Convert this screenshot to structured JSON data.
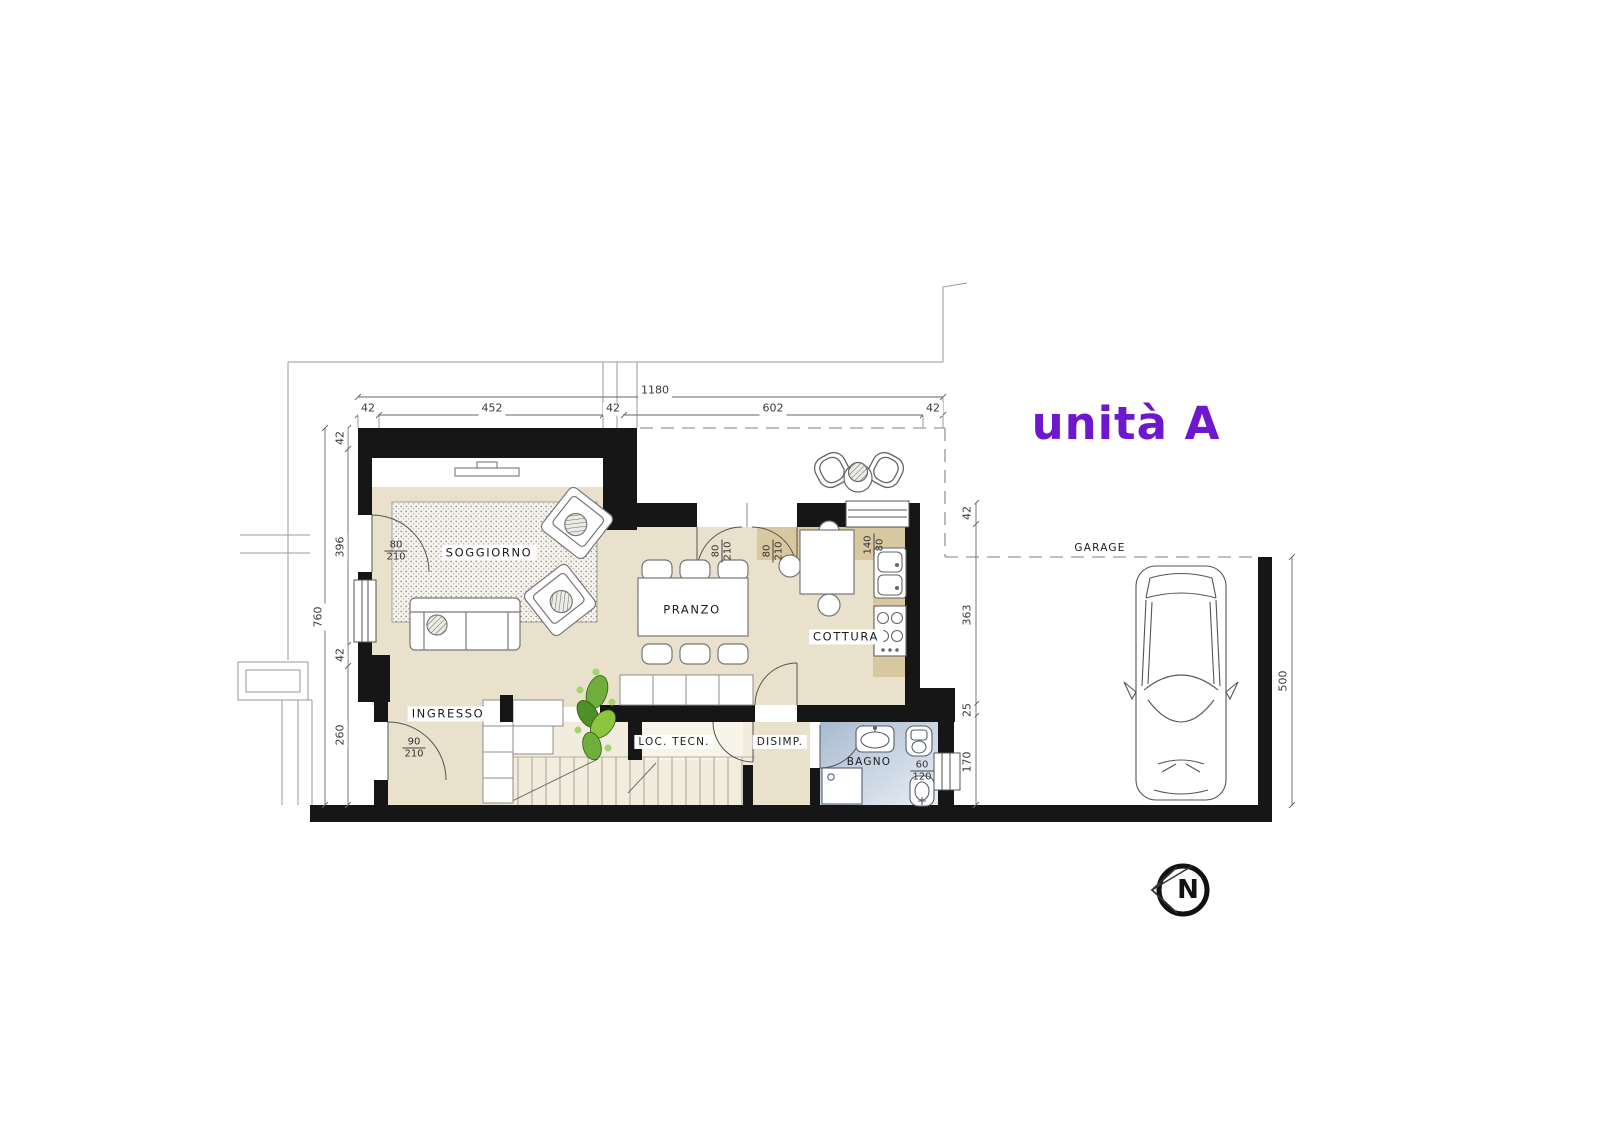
{
  "title": "unità A",
  "north_label": "N",
  "rooms": {
    "soggiorno": "SOGGIORNO",
    "pranzo": "PRANZO",
    "cottura": "COTTURA",
    "ingresso": "INGRESSO",
    "loc_tecn": "LOC. TECN.",
    "disimp": "DISIMP.",
    "bagno": "BAGNO",
    "garage": "GARAGE"
  },
  "dims": {
    "overall_width": "1180",
    "top": [
      "42",
      "452",
      "42",
      "602",
      "42"
    ],
    "left_overall": "760",
    "left": [
      "42",
      "396",
      "42",
      "260"
    ],
    "right": [
      "42",
      "363",
      "25",
      "170"
    ],
    "garage_depth": "500"
  },
  "openings": {
    "soggiorno_door": {
      "w": "80",
      "h": "210"
    },
    "ingresso_door": {
      "w": "90",
      "h": "210"
    },
    "pranzo_door_left": {
      "w": "80",
      "h": "210"
    },
    "pranzo_door_right": {
      "w": "80",
      "h": "210"
    },
    "cottura_window": {
      "w": "140",
      "h": "80"
    },
    "bagno_window": {
      "w": "60",
      "h": "120"
    }
  },
  "colors": {
    "accent_title": "#6d18cf",
    "wall": "#161616",
    "floor": "#e9e1cb",
    "kitchen_counter": "#d8c8a0",
    "bath_floor": "#b9c7d9",
    "plant_green": "#6fae3b"
  }
}
